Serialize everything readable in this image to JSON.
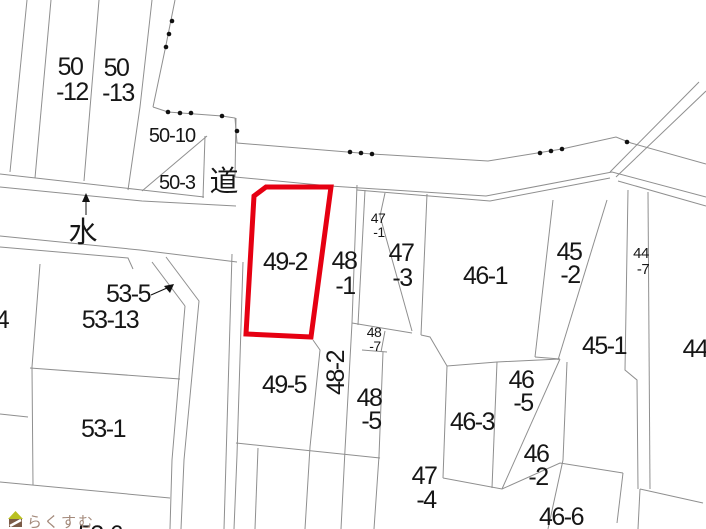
{
  "map": {
    "type": "cadastral-parcel-map",
    "highlighted_parcel": "49-2",
    "colors": {
      "background": "#ffffff",
      "boundary_line": "#8f8f8f",
      "text": "#161616",
      "highlight": "#e60012",
      "watermark_text": "#a3897a",
      "watermark_roof": "#b9c021",
      "watermark_house": "#7b5b47"
    },
    "labels": {
      "p50_12": {
        "l1": "50",
        "l2": "-12"
      },
      "p50_13": {
        "l1": "50",
        "l2": "-13"
      },
      "p50_10": {
        "text": "50-10"
      },
      "p50_3": {
        "text": "50-3"
      },
      "road": {
        "text": "道"
      },
      "water": {
        "text": "水"
      },
      "p49_2": {
        "text": "49-2"
      },
      "p48_1": {
        "l1": "48",
        "l2": "-1"
      },
      "p47_1": {
        "l1": "47",
        "l2": "-1"
      },
      "p47_3": {
        "l1": "47",
        "l2": "-3"
      },
      "p46_1": {
        "text": "46-1"
      },
      "p45_2": {
        "l1": "45",
        "l2": "-2"
      },
      "p44_7": {
        "l1": "44",
        "l2": "-7"
      },
      "p44": {
        "text": "44"
      },
      "p45_1": {
        "text": "45-1"
      },
      "p48_7": {
        "l1": "48",
        "l2": "-7"
      },
      "p48_2": {
        "text": "48-2"
      },
      "p48_5": {
        "l1": "48",
        "l2": "-5"
      },
      "p49_5": {
        "text": "49-5"
      },
      "p53_5": {
        "text": "53-5"
      },
      "p53_13": {
        "text": "53-13"
      },
      "p53_1": {
        "text": "53-1"
      },
      "p54_partial": {
        "text": "4"
      },
      "p53_6": {
        "text": "53-6"
      },
      "p47_4": {
        "l1": "47",
        "l2": "-4"
      },
      "p46_3": {
        "text": "46-3"
      },
      "p46_5": {
        "l1": "46",
        "l2": "-5"
      },
      "p46_2": {
        "l1": "46",
        "l2": "-2"
      },
      "p46_6": {
        "text": "46-6"
      }
    },
    "watermark": {
      "text": "らくすむ"
    }
  }
}
